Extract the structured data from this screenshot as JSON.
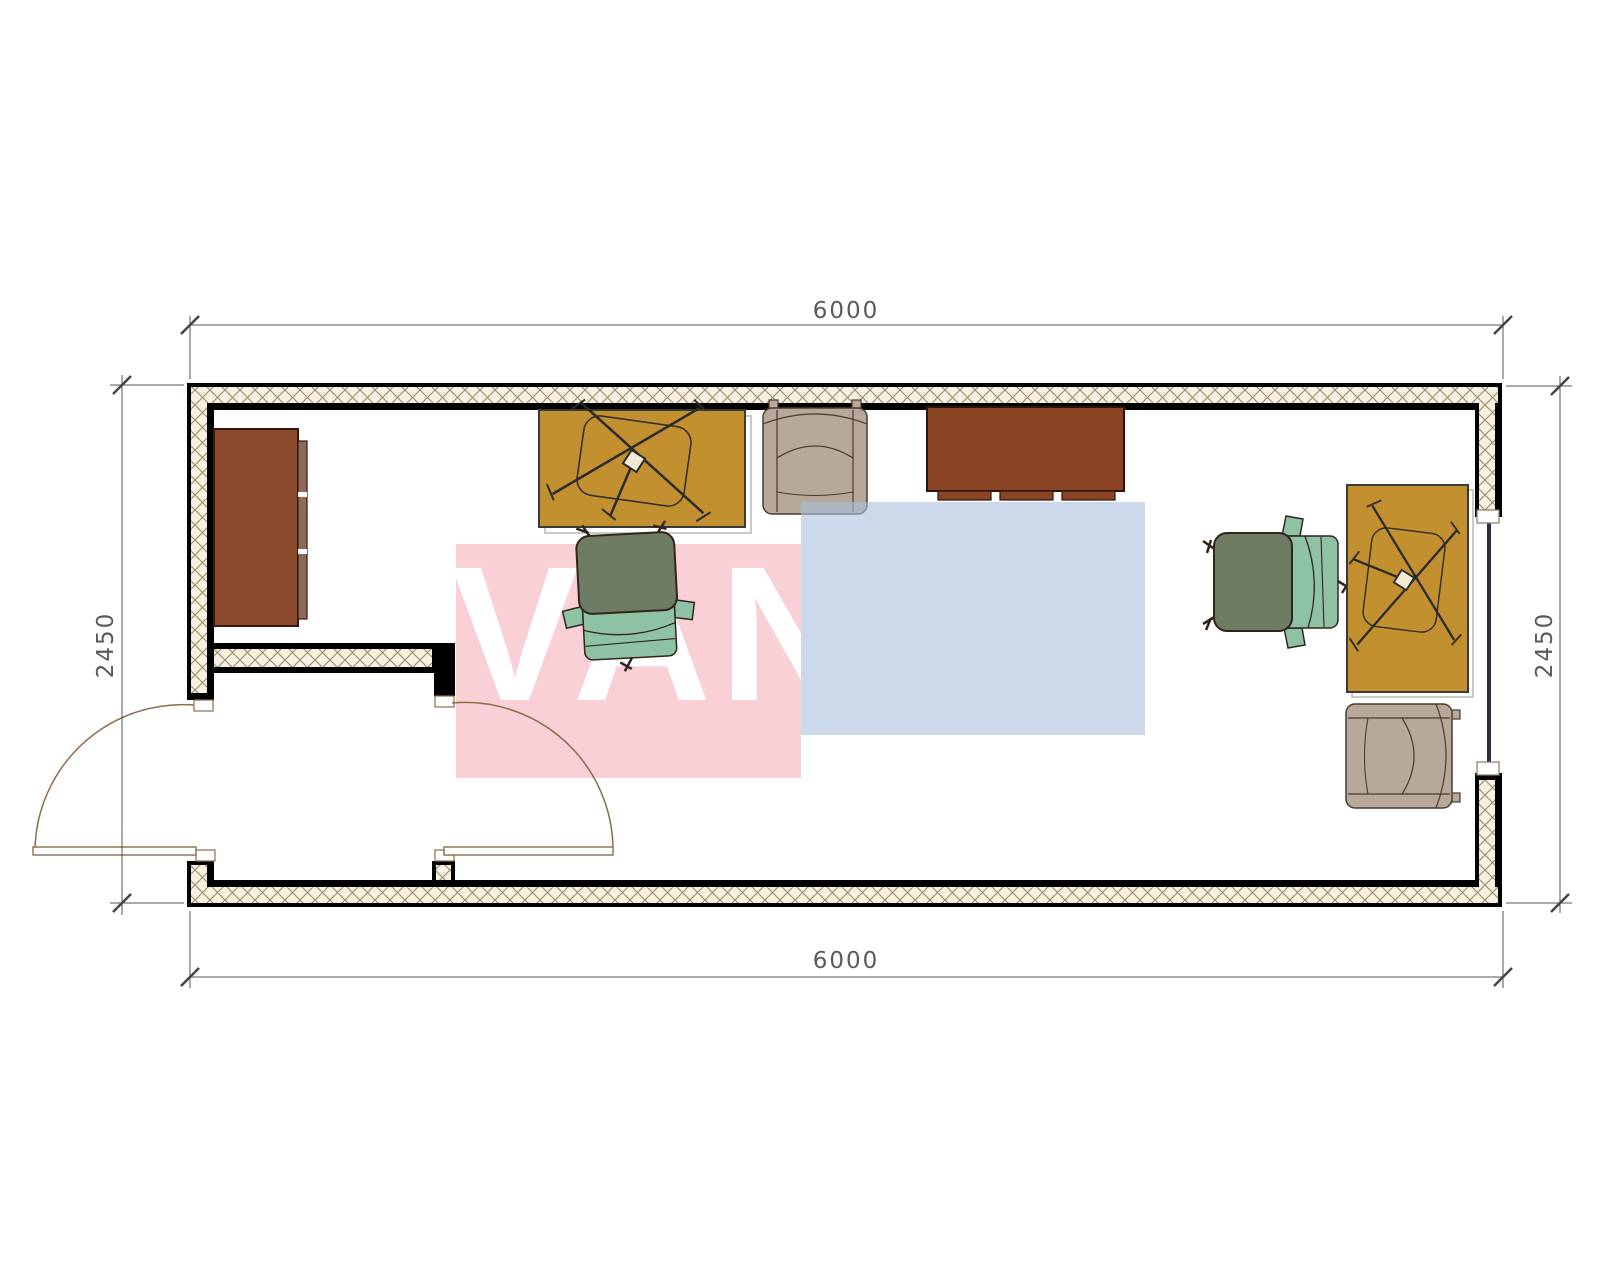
{
  "watermark": {
    "text": "VANDA",
    "text_color": "#ffffff",
    "pink_color": "#f8d0d6",
    "blue_color": "#a9c0dc"
  },
  "dimensions": {
    "top": "6000",
    "bottom": "6000",
    "left": "2450",
    "right": "2450"
  },
  "palette": {
    "wall_hatch_bg": "#f7f1e1",
    "wall_hatch_line": "#9b8a67",
    "wall_line": "#000000",
    "dim_line": "#5a5a5a",
    "door_line": "#8a6d4a",
    "window_glazing": "#2d2d3d",
    "wardrobe": "#8b4a2c",
    "wardrobe_front": "#8f6a5a",
    "credenza": "#8b4423",
    "desk": "#c2902e",
    "armchair": "#b6a99b",
    "chair_back": "#6d7c62",
    "chair_seat": "#8ec2a4"
  },
  "furniture": [
    {
      "name": "wardrobe-cabinet"
    },
    {
      "name": "desk-with-chair-base-symbol"
    },
    {
      "name": "armchair-top"
    },
    {
      "name": "credenza-cabinet"
    },
    {
      "name": "office-chair-center"
    },
    {
      "name": "office-chair-right"
    },
    {
      "name": "desk-with-chair-base-symbol-right"
    },
    {
      "name": "armchair-bottom-right"
    }
  ]
}
